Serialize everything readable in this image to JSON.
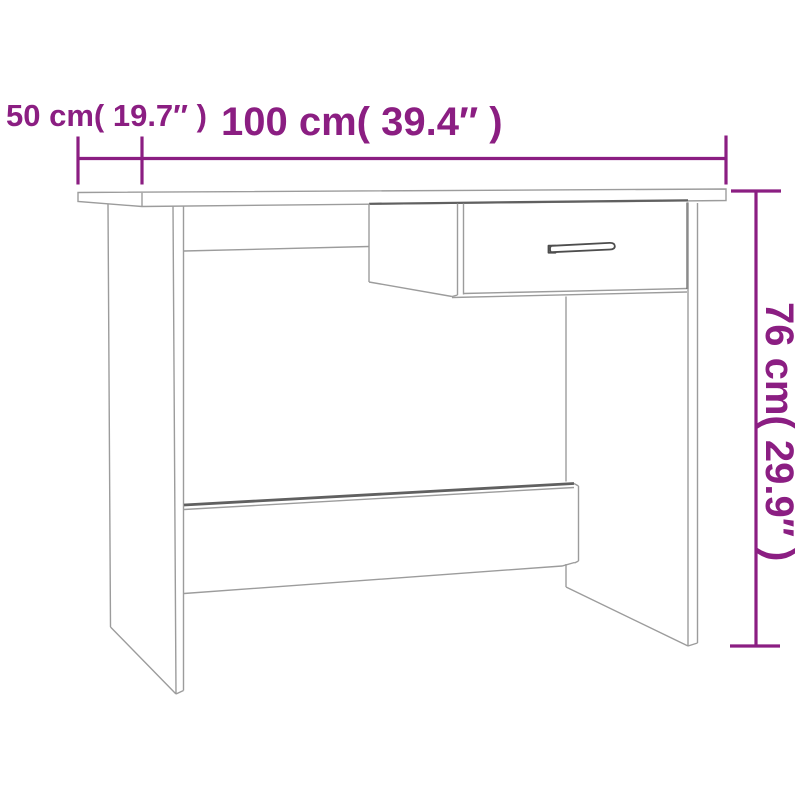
{
  "colors": {
    "background": "#ffffff",
    "accent": "#8b1e82",
    "line": "#9c9c9c",
    "line-dark": "#606060",
    "handle": "#4d4d4d"
  },
  "diagram": {
    "type": "product-dimension-line-drawing",
    "product": "desk with drawer",
    "dimensions": {
      "width": {
        "label": "100 cm( 39.4″ )",
        "value_cm": "100",
        "value_in": "39.4"
      },
      "depth": {
        "label": "50 cm( 19.7″ )",
        "value_cm": "50",
        "value_in": "19.7"
      },
      "height": {
        "label": "76 cm( 29.9″ )",
        "value_cm": "76",
        "value_in": "29.9"
      }
    }
  }
}
